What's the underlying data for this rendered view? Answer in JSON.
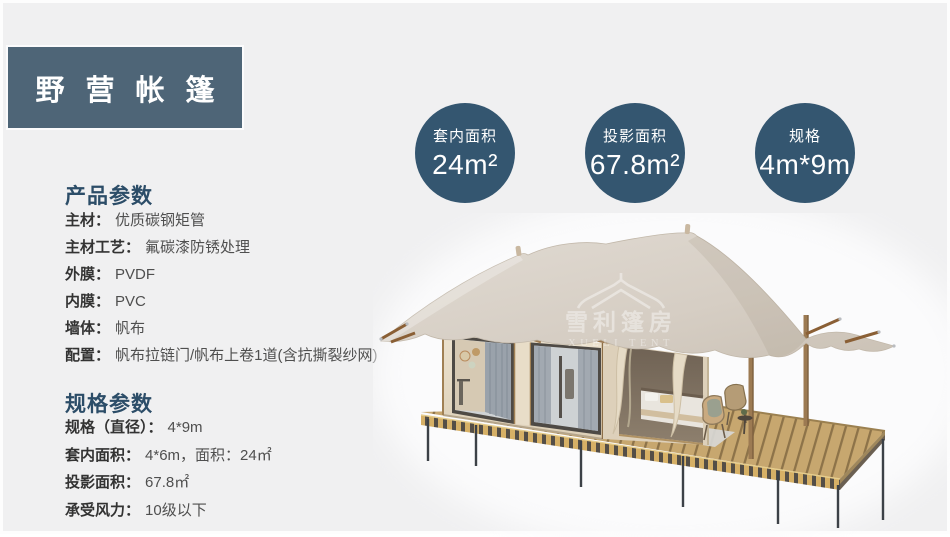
{
  "page": {
    "title": "野营帐篷"
  },
  "stat_circles": [
    {
      "label": "套内面积",
      "value": "24m²"
    },
    {
      "label": "投影面积",
      "value": "67.8m²"
    },
    {
      "label": "规格",
      "value": "4m*9m"
    }
  ],
  "product_params": {
    "heading": "产品参数",
    "items": [
      {
        "label": "主材：",
        "value": "优质碳钢矩管"
      },
      {
        "label": "主材工艺：",
        "value": "氟碳漆防锈处理"
      },
      {
        "label": "外膜：",
        "value": "PVDF"
      },
      {
        "label": "内膜：",
        "value": "PVC"
      },
      {
        "label": "墙体：",
        "value": "帆布"
      },
      {
        "label": "配置：",
        "value": "帆布拉链门/帆布上卷1道(含抗撕裂纱网)"
      }
    ]
  },
  "spec_params": {
    "heading": "规格参数",
    "items": [
      {
        "label": "规格（直径）：",
        "value": "4*9m"
      },
      {
        "label": "套内面积：",
        "value": "4*6m，面积：24㎡"
      },
      {
        "label": "投影面积：",
        "value": "67.8㎡"
      },
      {
        "label": "承受风力：",
        "value": "10级以下"
      }
    ]
  },
  "tent_watermark": {
    "cn": "雪利篷房",
    "en": "XUELI TENT"
  },
  "colors": {
    "background": "#f0f0f1",
    "title_bg": "#4e6577",
    "circle_bg": "#345670",
    "heading_text": "#2c4d68",
    "canvas_roof": "#d9d2c8",
    "deck_wood": "#c7a76f"
  }
}
